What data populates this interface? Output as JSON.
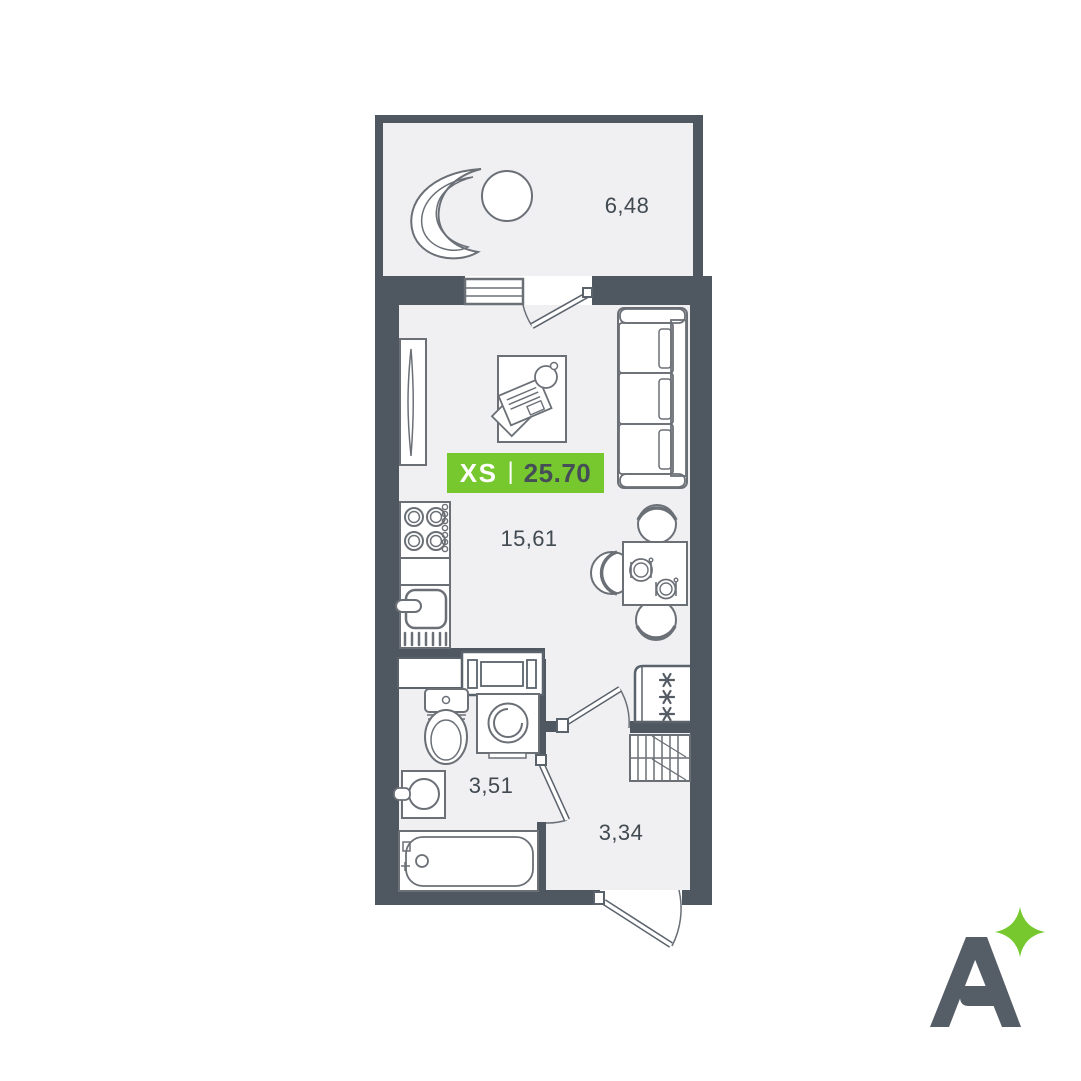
{
  "floorplan": {
    "badge": {
      "size_label": "XS",
      "divider": "|",
      "total_area": "25.70"
    },
    "rooms": {
      "balcony": {
        "area": "6,48"
      },
      "living": {
        "area": "15,61"
      },
      "bathroom": {
        "area": "3,51"
      },
      "hallway": {
        "area": "3,34"
      }
    },
    "colors": {
      "wall": "#4f5761",
      "floor": "#f0f0f2",
      "furniture_outline": "#6b7077",
      "accent_green": "#76c82e",
      "label_text": "#414951",
      "badge_size_text": "#ffffff",
      "badge_area_text": "#454d57",
      "logo": "#555d66"
    },
    "logo": {
      "letter": "A",
      "sparkle": "four-point-star"
    }
  }
}
